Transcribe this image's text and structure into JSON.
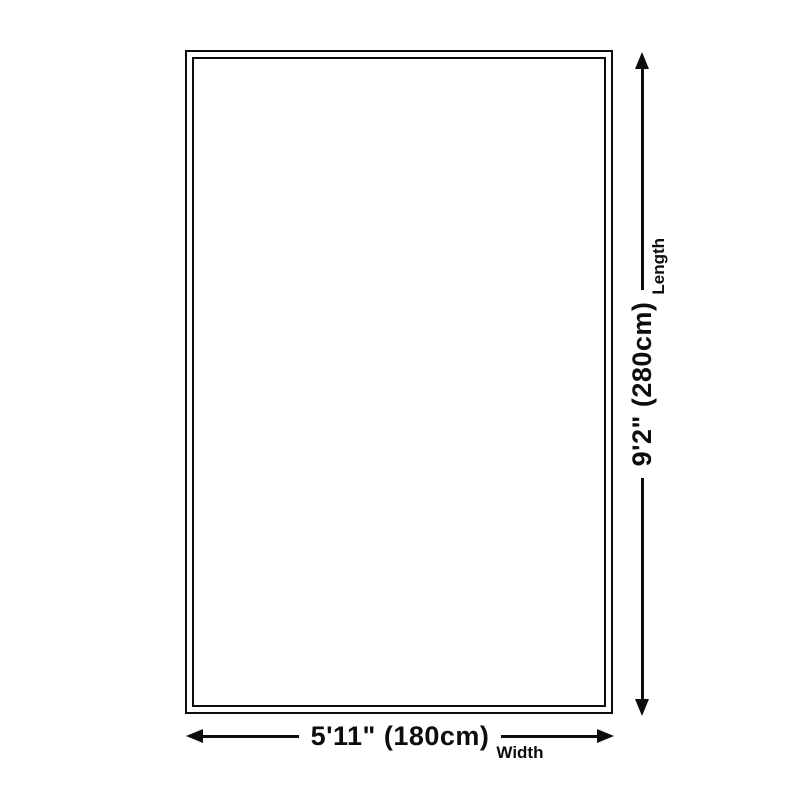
{
  "diagram": {
    "background_color": "#ffffff",
    "line_color": "#0d0d0d",
    "width_dimension": {
      "value": "5'11\" (180cm)",
      "label": "Width"
    },
    "length_dimension": {
      "value": "9'2\" (280cm)",
      "label": "Length"
    }
  }
}
